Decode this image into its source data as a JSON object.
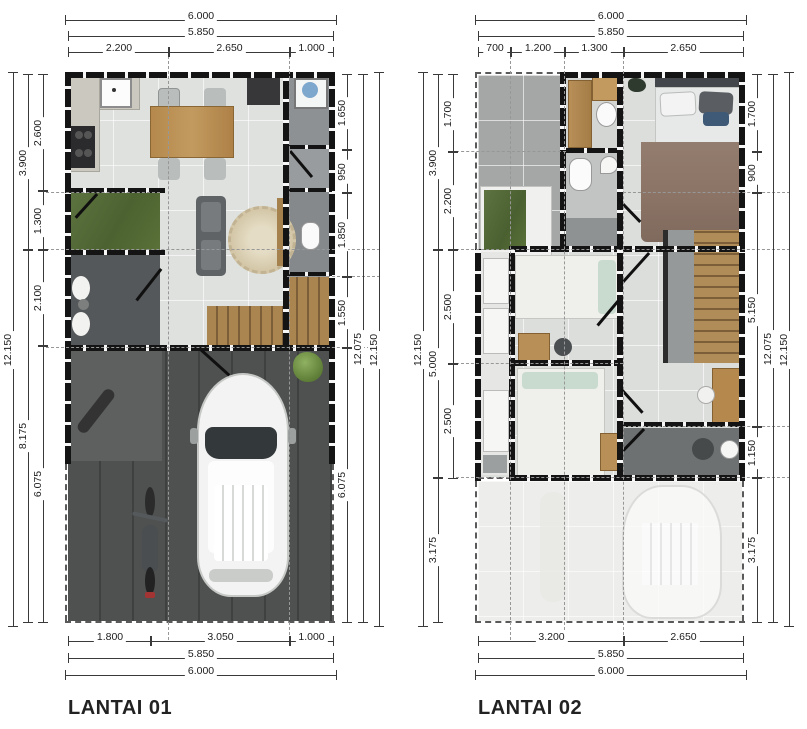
{
  "plans": [
    {
      "label": "LANTAI 01",
      "dims": {
        "top": {
          "total": "6.000",
          "inner": "5.850",
          "chain": [
            "2.200",
            "2.650",
            "1.000"
          ]
        },
        "bottom": {
          "chain": [
            "1.800",
            "3.050",
            "1.000"
          ],
          "inner": "5.850",
          "total": "6.000"
        },
        "left": {
          "outer": "12.150",
          "mid": [
            "3.900",
            "8.175"
          ],
          "chain": [
            "2.600",
            "1.300",
            "2.100",
            "6.075"
          ]
        },
        "right": {
          "chain": [
            "1.650",
            "950",
            "1.850",
            "1.550",
            "6.075"
          ],
          "mid": "12.075",
          "outer": "12.150"
        }
      }
    },
    {
      "label": "LANTAI 02",
      "dims": {
        "top": {
          "total": "6.000",
          "inner": "5.850",
          "chain": [
            "700",
            "1.200",
            "1.300",
            "2.650"
          ]
        },
        "bottom": {
          "chain": [
            "3.200",
            "2.650"
          ],
          "inner": "5.850",
          "total": "6.000"
        },
        "left": {
          "outer": "12.150",
          "mid": [
            "3.900",
            "5.000",
            "3.175"
          ],
          "chain": [
            "1.700",
            "2.200",
            "2.500",
            "2.500"
          ]
        },
        "right": {
          "chain": [
            "1.700",
            "900",
            "5.150",
            "1.150",
            "3.175"
          ],
          "mid": "12.075",
          "outer": "12.150"
        }
      }
    }
  ],
  "colors": {
    "wall": "#141414",
    "floor_tile": "#dfe1df",
    "paving": "#4e514f",
    "terrace": "#a4a7a6",
    "wood": "#b08d58",
    "grass": "#57703a",
    "duvet": "#8b7365"
  }
}
